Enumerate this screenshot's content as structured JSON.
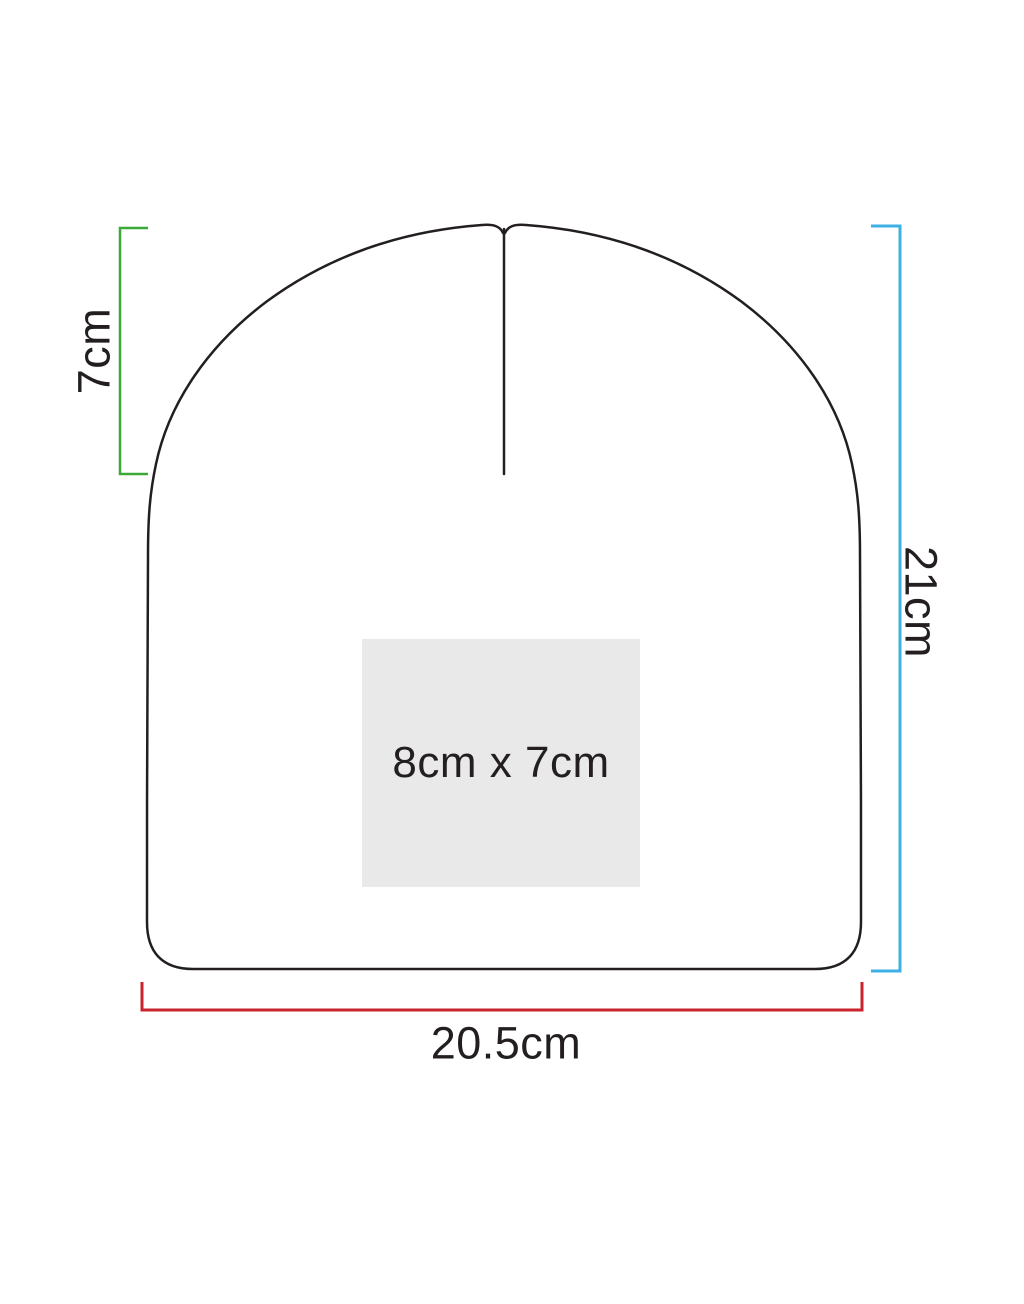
{
  "diagram": {
    "outline_color": "#231f20",
    "background_color": "#ffffff"
  },
  "dimensions": {
    "crown_seam": {
      "label": "7cm",
      "color": "#3aa935"
    },
    "height": {
      "label": "21cm",
      "color": "#3cb0e4"
    },
    "width": {
      "label": "20.5cm",
      "color": "#c9232b"
    }
  },
  "print_area": {
    "label": "8cm x 7cm",
    "fill": "#e9e9e9",
    "text_color": "#231f20"
  }
}
